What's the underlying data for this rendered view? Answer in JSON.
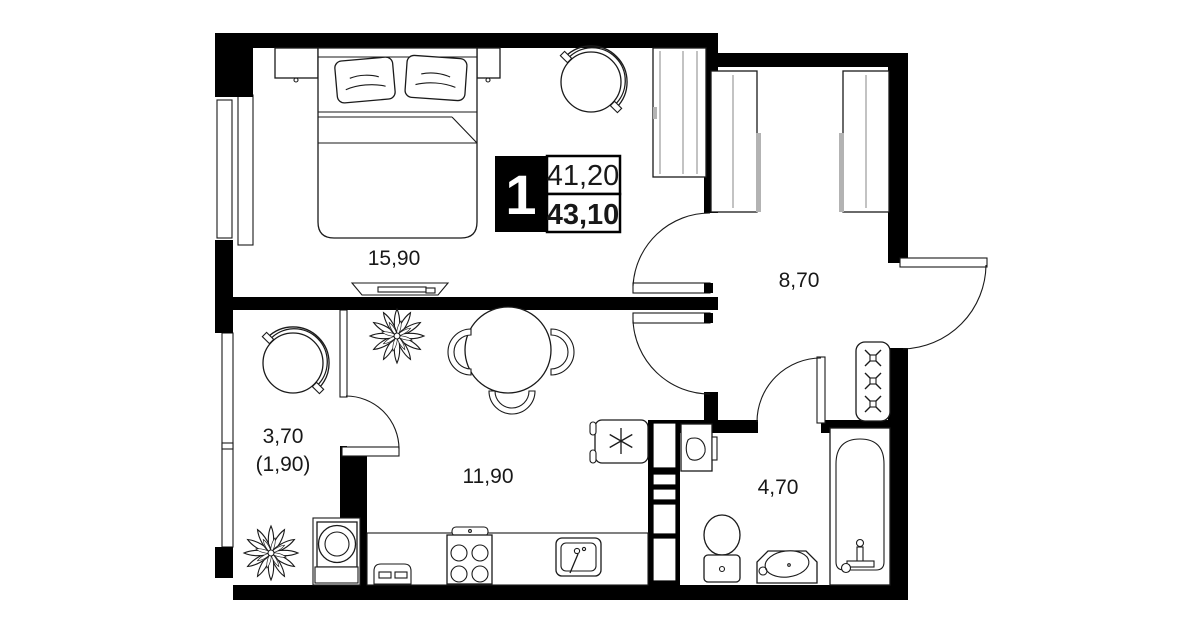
{
  "badge": {
    "rooms_count": "1",
    "living_area": "41,20",
    "total_area": "43,10"
  },
  "rooms": {
    "bedroom": {
      "area": "15,90"
    },
    "hallway": {
      "area": "8,70"
    },
    "kitchen_living": {
      "area": "11,90"
    },
    "bathroom": {
      "area": "4,70"
    },
    "balcony": {
      "area": "3,70",
      "area_coefficient": "(1,90)"
    }
  },
  "icons": {
    "vent_shaft": "x-cross-icon",
    "stove_marker": "asterisk-icon",
    "plants": "flower-icon"
  },
  "colors": {
    "walls": "#000000",
    "background": "#ffffff",
    "furniture_line": "#1a1a1a"
  }
}
